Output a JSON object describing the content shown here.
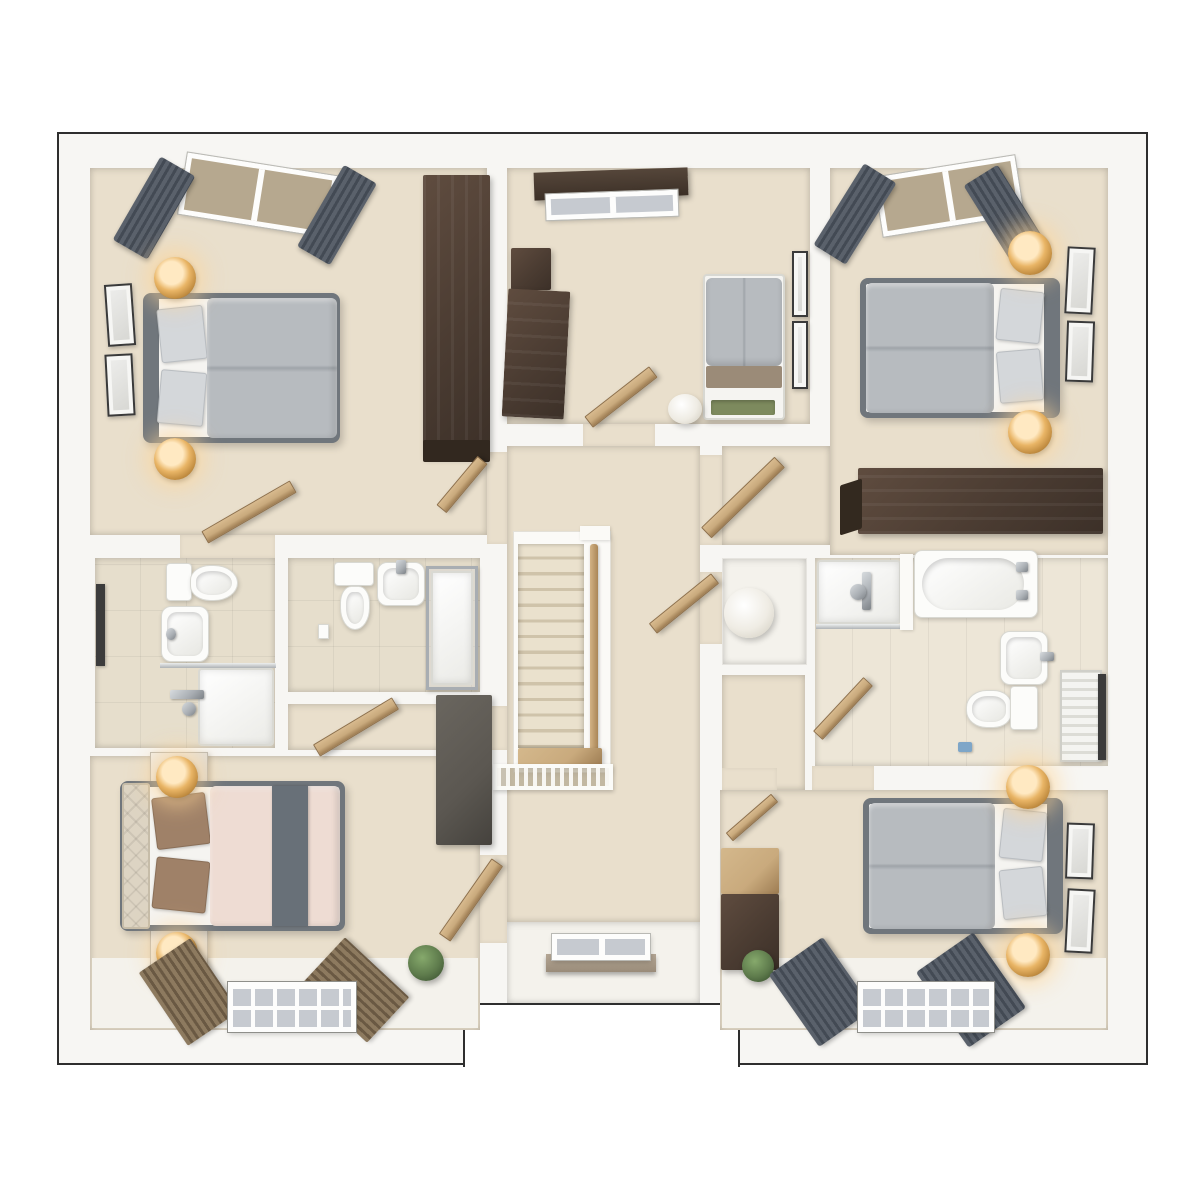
{
  "meta": {
    "title": "Upper floor 3D floor plan render",
    "type": "architectural-floorplan-3d-top-view",
    "visible_text": "none"
  },
  "palette": {
    "page_bg": "#ffffff",
    "outline": "#2e2e2e",
    "wall": "#f7f6f3",
    "wall_edge": "#e6e3dd",
    "carpet": "#e9dfcc",
    "white_floor": "#f4f2ec",
    "tile_wall": "#e6decc",
    "tile_floor": "#ede6d7",
    "wood_dark": "#4b3c32",
    "wood_grain": "#5f4c3f",
    "oak": "#c9aa7d",
    "oak_dark": "#9d7c52",
    "gray_unit": "#5b5751",
    "duvet": "#b7bbbf",
    "duvet_edge": "#9fa4a9",
    "bed_frame": "#70767c",
    "pillow": "#d4d7da",
    "mattress": "#f5f4f1",
    "blush": "#eedcd3",
    "runner": "#687078",
    "pillow_brown": "#9f8168",
    "headboard_cream": "#ddd4c3",
    "curtain": "#5a616b",
    "curtain_dark": "#434a54",
    "blind": "#8d7a5f",
    "blind_dark": "#6a5943",
    "glass": "#c6cad0",
    "glass_taupe": "#b6a88f",
    "pelmet": "#3c3027",
    "porcelain": "#fcfcfa",
    "porcelain_edge": "#d8d8d2",
    "chrome": "#a8adb2",
    "gold": "#c18c40",
    "gold_hi": "#ffe9c2",
    "plant": "#5e7b4c",
    "plant_dark": "#33492a",
    "tread": "#eae1cd",
    "tread_edge": "#cfc3aa",
    "sill": "#b4a694",
    "accent_blue": "#7ea6c8"
  },
  "rooms": [
    {
      "name": "bedroom-top-left",
      "items": [
        "double-bed-gray",
        "tall-wardrobe-dark",
        "table-lamp x2",
        "wall-art x2",
        "window-with-curtains",
        "door-to-landing",
        "door-to-ensuite"
      ]
    },
    {
      "name": "bedroom-top-middle",
      "items": [
        "single-bed",
        "desk-dark",
        "cabinet-dark",
        "laundry-basket-round",
        "wall-art x2",
        "window-with-pelmet",
        "door-to-landing"
      ]
    },
    {
      "name": "bedroom-top-right",
      "items": [
        "double-bed-gray",
        "low-wardrobe-dark",
        "table-lamp x2",
        "wall-art x2",
        "window-with-curtains",
        "door-to-landing"
      ]
    },
    {
      "name": "ensuite-left",
      "items": [
        "toilet",
        "basin",
        "shower-tray",
        "shower-mixer",
        "mirror"
      ]
    },
    {
      "name": "ensuite-middle",
      "items": [
        "toilet",
        "basin",
        "shower-enclosure",
        "light-switch",
        "door"
      ]
    },
    {
      "name": "family-bathroom",
      "items": [
        "bathtub",
        "shower-tray",
        "shower-screen",
        "basin",
        "toilet",
        "radiator",
        "towel-rail",
        "door",
        "laundry-sphere"
      ]
    },
    {
      "name": "landing",
      "items": [
        "staircase-13-treads",
        "handrail-oak",
        "spindle-balustrade",
        "rear-window",
        "door-to-bathroom-lobby"
      ]
    },
    {
      "name": "bedroom-bottom-left",
      "items": [
        "double-bed-blush",
        "nightstand x2",
        "table-lamp x2",
        "wardrobe-gray",
        "plant",
        "window-with-wood-blinds",
        "door"
      ]
    },
    {
      "name": "bedroom-bottom-right",
      "items": [
        "double-bed-gray",
        "dresser-two-tone",
        "table-lamp x2",
        "wall-art x2",
        "plant",
        "window-with-curtains",
        "door"
      ]
    }
  ]
}
